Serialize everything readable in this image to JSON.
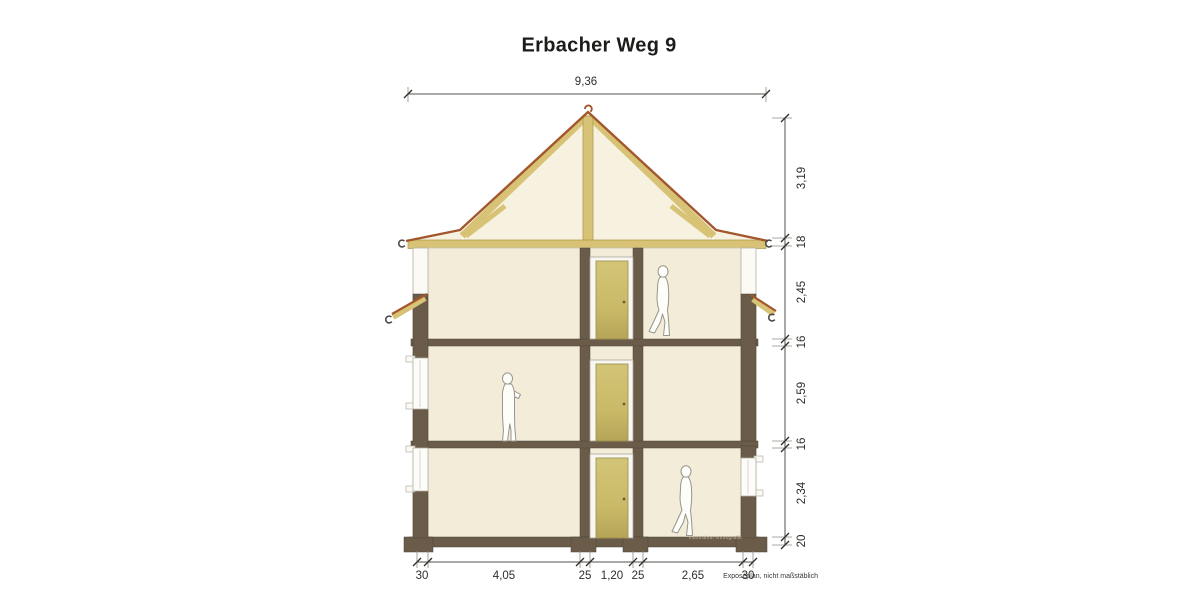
{
  "title": "Erbacher Weg 9",
  "note": "Exposéplan, nicht maßstäblich",
  "watermark": "illustration immografik",
  "dimensions": {
    "top": {
      "total_width": "9,36"
    },
    "right": {
      "values": [
        "3,19",
        "18",
        "2,45",
        "16",
        "2,59",
        "16",
        "2,34",
        "20"
      ]
    },
    "bottom": {
      "values": [
        "30",
        "4,05",
        "25",
        "1,20",
        "25",
        "2,65",
        "30"
      ]
    }
  },
  "drawing": {
    "kind": "residential building cross-section",
    "floors_shown": 3,
    "figures": [
      "walking person on top floor",
      "standing person on middle floor",
      "walking person on ground floor"
    ],
    "colors": {
      "interior_cream": "#f3ecd8",
      "timber_tan": "#d7c276",
      "roof_edge_red": "#a2572c",
      "structure_brown": "#6a5c49",
      "door_khaki": "#c9ba68"
    }
  }
}
